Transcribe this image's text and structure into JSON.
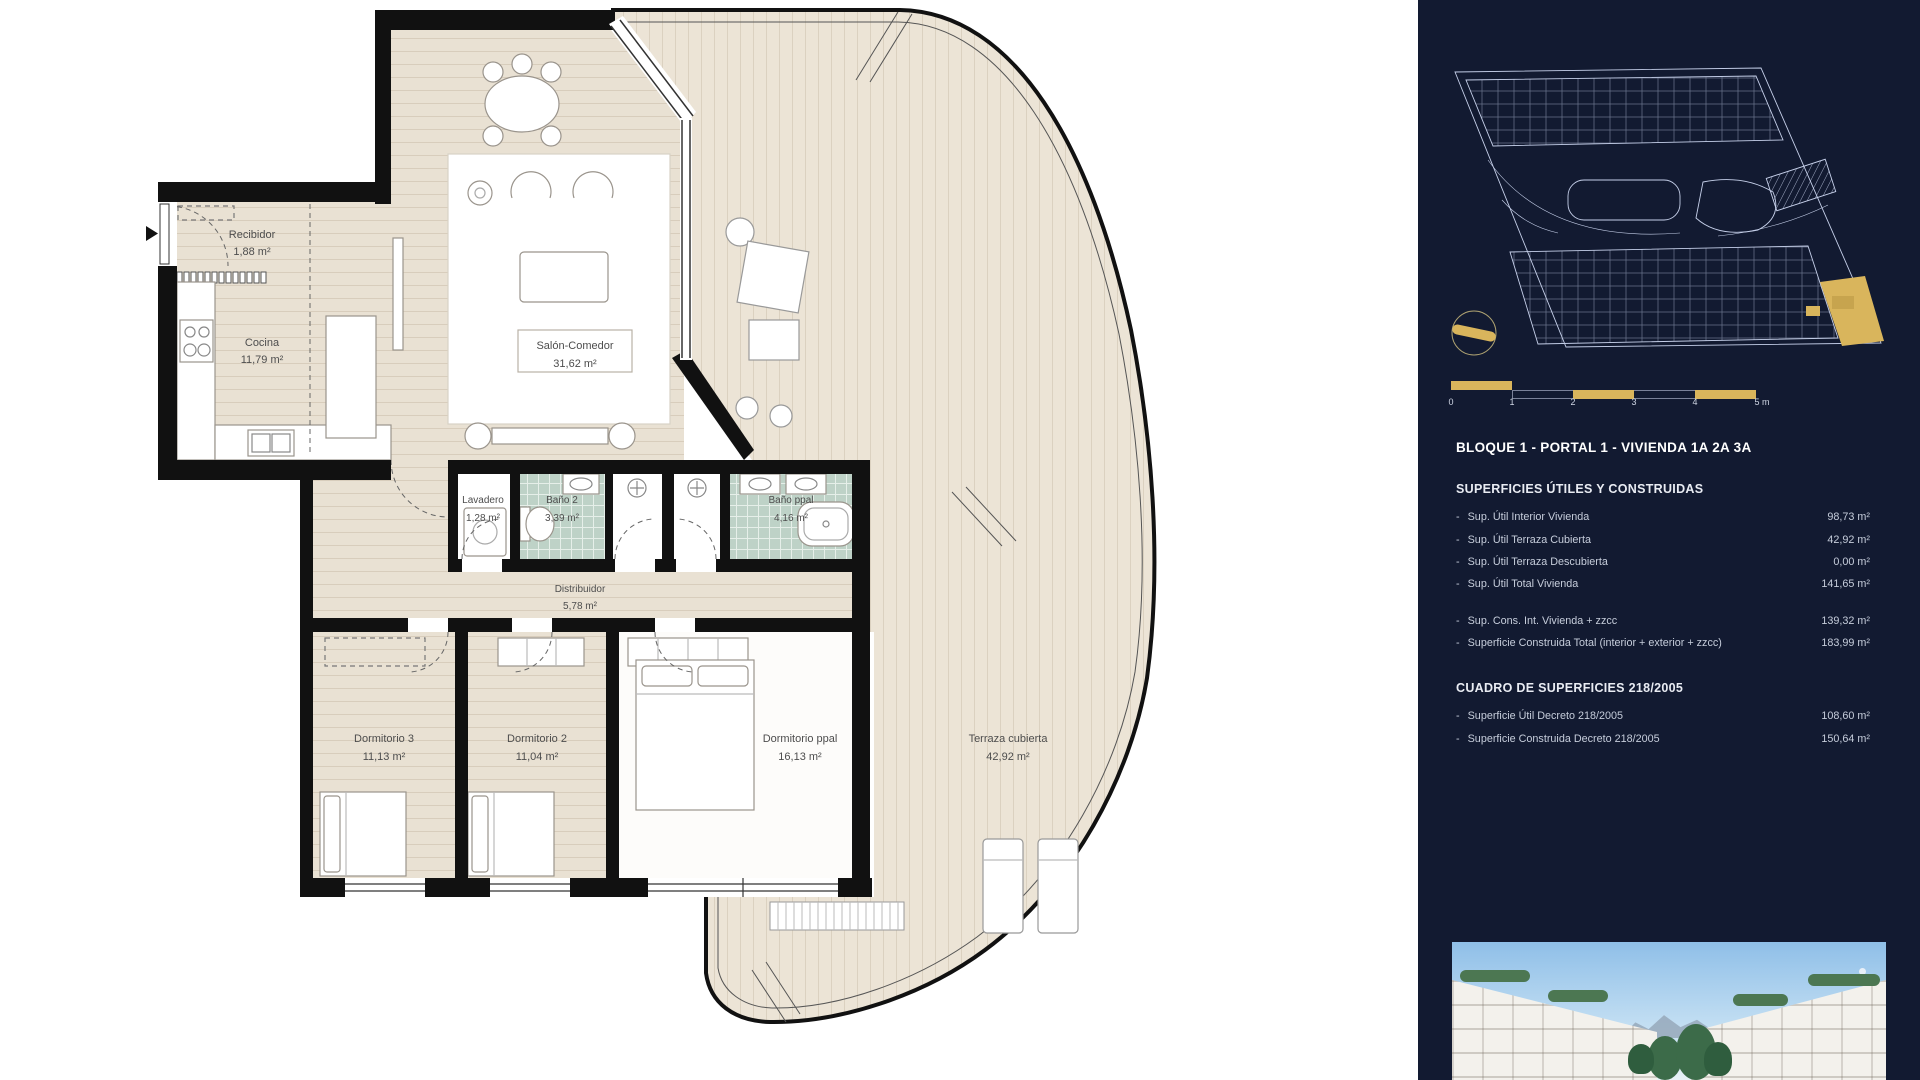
{
  "colors": {
    "accent_gold": "#d9b55c",
    "sidebar_bg": "#121a31",
    "floor_beige": "#e9e1d3",
    "tile_teal": "#bed2c7",
    "wall_black": "#111111"
  },
  "plan": {
    "rooms": [
      {
        "name": "Recibidor",
        "area": "1,88 m²"
      },
      {
        "name": "Cocina",
        "area": "11,79 m²"
      },
      {
        "name": "Salón-Comedor",
        "area": "31,62 m²"
      },
      {
        "name": "Lavadero",
        "area": "1,28 m²"
      },
      {
        "name": "Baño 2",
        "area": "3,39 m²"
      },
      {
        "name": "Baño ppal",
        "area": "4,16 m²"
      },
      {
        "name": "Distribuidor",
        "area": "5,78 m²"
      },
      {
        "name": "Dormitorio 3",
        "area": "11,13 m²"
      },
      {
        "name": "Dormitorio 2",
        "area": "11,04 m²"
      },
      {
        "name": "Dormitorio ppal",
        "area": "16,13 m²"
      },
      {
        "name": "Terraza cubierta",
        "area": "42,92 m²"
      }
    ]
  },
  "sidebar": {
    "bullet": "-",
    "title": "BLOQUE 1 - PORTAL 1 - VIVIENDA 1A 2A 3A",
    "scale_labels": [
      "0",
      "1",
      "2",
      "3",
      "4",
      "5 m"
    ],
    "sections": [
      {
        "heading": "SUPERFICIES ÚTILES Y CONSTRUIDAS",
        "rows": [
          {
            "label": "Sup. Útil Interior Vivienda",
            "value": "98,73 m²"
          },
          {
            "label": "Sup. Útil Terraza Cubierta",
            "value": "42,92 m²"
          },
          {
            "label": "Sup. Útil Terraza Descubierta",
            "value": "0,00 m²"
          },
          {
            "label": "Sup. Útil Total Vivienda",
            "value": "141,65 m²"
          },
          {
            "label": "Sup. Cons. Int. Vivienda + zzcc",
            "value": "139,32 m²"
          },
          {
            "label": "Superficie Construida Total (interior + exterior + zzcc)",
            "value": "183,99 m²"
          }
        ]
      },
      {
        "heading": "CUADRO DE SUPERFICIES 218/2005",
        "rows": [
          {
            "label": "Superficie Útil Decreto 218/2005",
            "value": "108,60 m²"
          },
          {
            "label": "Superficie Construida Decreto 218/2005",
            "value": "150,64 m²"
          }
        ]
      }
    ]
  }
}
